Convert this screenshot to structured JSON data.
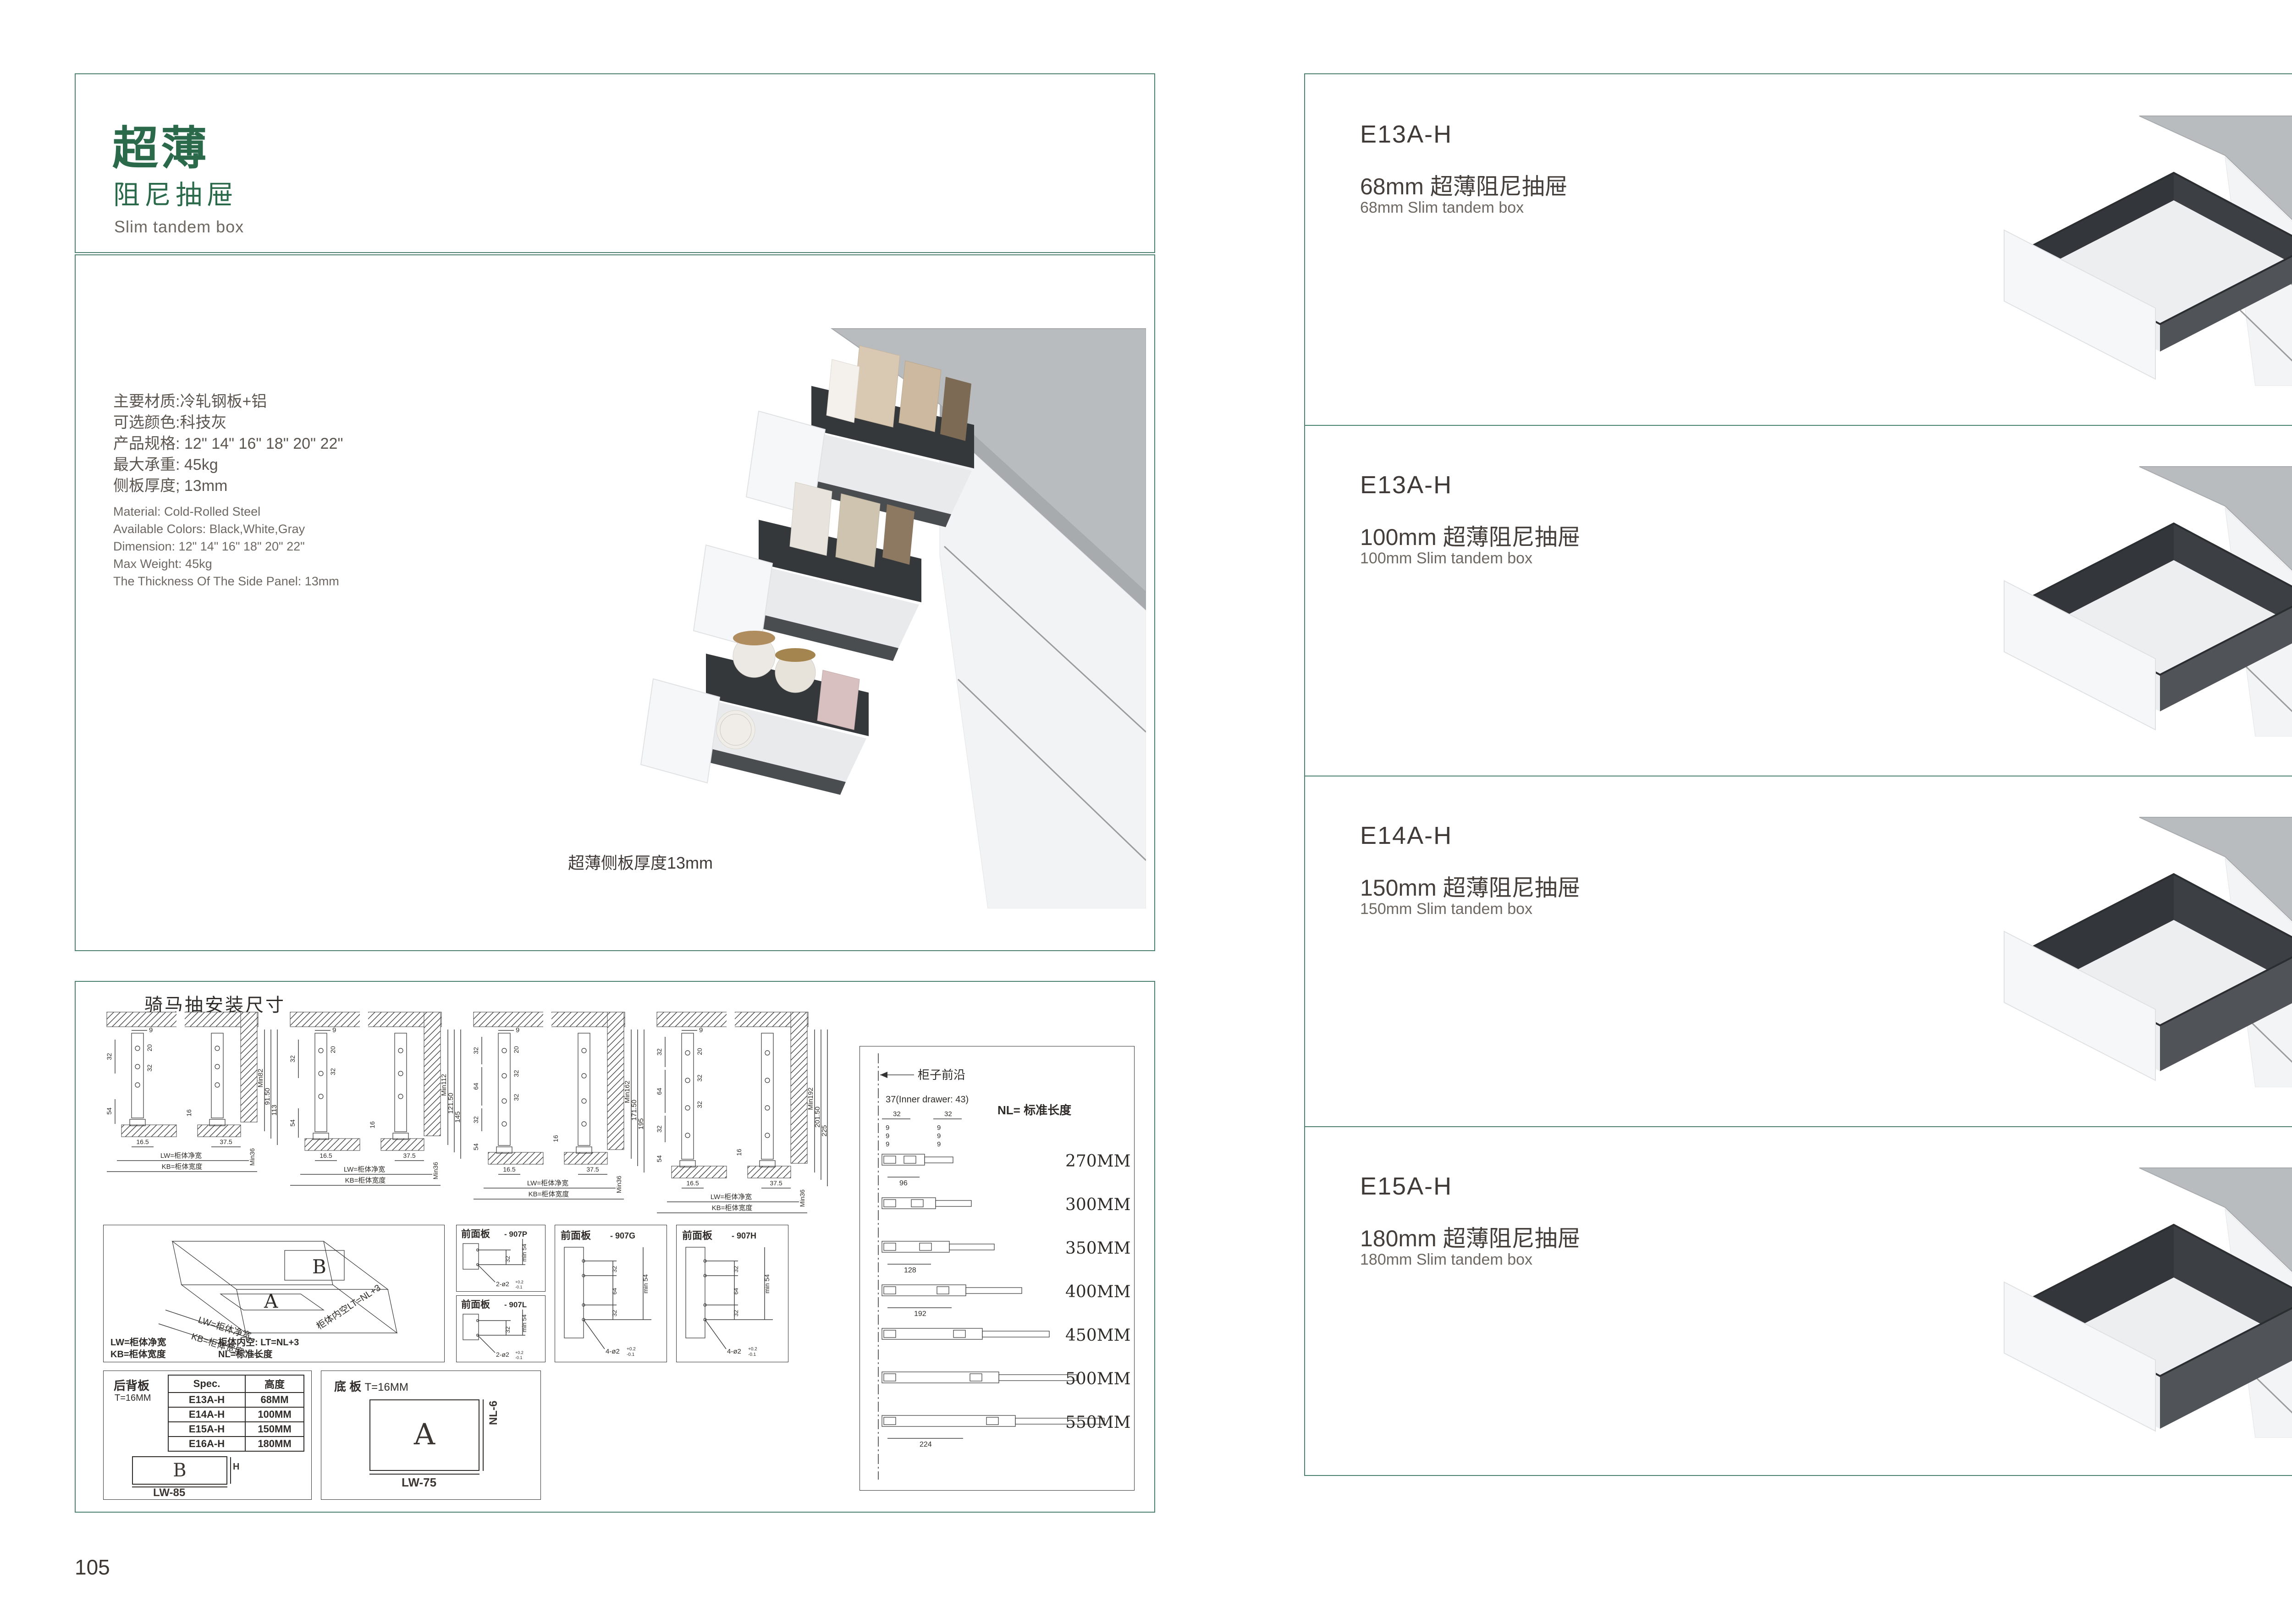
{
  "colors": {
    "accent_green": "#2a6a4b",
    "border_teal": "#4b8071",
    "text_dark": "#3b3632",
    "text_gray": "#6e6862",
    "photo_charcoal": "#35383b",
    "photo_counter": "#b9bcbe"
  },
  "page_left": {
    "page_number": "105",
    "header": {
      "title_cn_bold": "超薄",
      "title_cn_sub": "阻尼抽屉",
      "title_en": "Slim tandem box"
    },
    "specs_cn": [
      "主要材质:冷轧钢板+铝",
      "可选颜色:科技灰",
      "产品规格: 12\" 14\" 16\" 18\" 20\" 22\"",
      "最大承重: 45kg",
      "侧板厚度; 13mm"
    ],
    "specs_en": [
      "Material: Cold-Rolled Steel",
      "Available Colors: Black,White,Gray",
      "Dimension: 12\" 14\" 16\" 18\" 20\" 22\"",
      "Max Weight: 45kg",
      "The Thickness Of The Side Panel: 13mm"
    ],
    "photo_caption": "超薄侧板厚度13mm",
    "tech": {
      "title": "骑马抽安装尺寸",
      "cross_sections": [
        {
          "top9": "9",
          "col20": "20",
          "col32a": "32",
          "col32b": "",
          "leftA": "32",
          "leftB": "",
          "leftC": "",
          "left54": "54",
          "mid16": "16",
          "r1": "Min82",
          "r2": "91.50",
          "r3": "113",
          "b1": "16.5",
          "b2": "37.5",
          "b3": "Min36",
          "lw": "LW=柜体净宽",
          "kb": "KB=柜体宽度"
        },
        {
          "top9": "9",
          "col20": "20",
          "col32a": "32",
          "col32b": "",
          "leftA": "32",
          "leftB": "",
          "leftC": "",
          "left54": "54",
          "mid16": "16",
          "r1": "Min112",
          "r2": "121.50",
          "r3": "145",
          "b1": "16.5",
          "b2": "37.5",
          "b3": "Min36",
          "lw": "LW=柜体净宽",
          "kb": "KB=柜体宽度"
        },
        {
          "top9": "9",
          "col20": "20",
          "col32a": "32",
          "col32b": "32",
          "leftA": "32",
          "leftB": "64",
          "leftC": "32",
          "left54": "54",
          "mid16": "16",
          "r1": "Min162",
          "r2": "171.50",
          "r3": "195",
          "b1": "16.5",
          "b2": "37.5",
          "b3": "Min36",
          "lw": "LW=柜体净宽",
          "kb": "KB=柜体宽度"
        },
        {
          "top9": "9",
          "col20": "20",
          "col32a": "32",
          "col32b": "32",
          "leftA": "32",
          "leftB": "64",
          "leftC": "32",
          "left54": "54",
          "mid16": "16",
          "r1": "Min192",
          "r2": "201.50",
          "r3": "225",
          "b1": "16.5",
          "b2": "37.5",
          "b3": "Min36",
          "lw": "LW=柜体净宽",
          "kb": "KB=柜体宽度"
        }
      ],
      "box3d": {
        "letter_a": "A",
        "letter_b": "B",
        "edge_lw": "LW=柜体净宽",
        "edge_kb": "KB=柜体宽度",
        "edge_lt": "柜体内空LT=NL+3",
        "legend_lw": "LW=柜体净宽",
        "legend_lt": "柜体内空: LT=NL+3",
        "legend_kb": "KB=柜体宽度",
        "legend_nl": "NL=标准长度"
      },
      "front_panels": [
        {
          "title": "前面板",
          "code": "- 907P",
          "dim32": "32",
          "min54": "min 54",
          "holes": "2-ø2",
          "tol_up": "+0.2",
          "tol_dn": "-0.1"
        },
        {
          "title": "前面板",
          "code": "- 907L",
          "dim32": "32",
          "min54": "min 54",
          "holes": "2-ø2",
          "tol_up": "+0.2",
          "tol_dn": "-0.1"
        },
        {
          "title": "前面板",
          "code": "- 907G",
          "dim32a": "32",
          "dim64": "64",
          "dim32b": "32",
          "min54": "min 54",
          "holes": "4-ø2",
          "tol_up": "+0.2",
          "tol_dn": "-0.1"
        },
        {
          "title": "前面板",
          "code": "- 907H",
          "dim32a": "32",
          "dim64": "64",
          "dim32b": "32",
          "min54": "min 54",
          "holes": "4-ø2",
          "tol_up": "+0.2",
          "tol_dn": "-0.1"
        }
      ],
      "back_panel": {
        "name": "后背板",
        "thickness": "T=16MM",
        "table": {
          "h1": "Spec.",
          "h2": "高度",
          "rows": [
            [
              "E13A-H",
              "68MM"
            ],
            [
              "E14A-H",
              "100MM"
            ],
            [
              "E15A-H",
              "150MM"
            ],
            [
              "E16A-H",
              "180MM"
            ]
          ]
        },
        "letter": "B",
        "dim_h": "H",
        "dim_w": "LW-85"
      },
      "bottom_panel": {
        "name": "底 板",
        "thickness": "T=16MM",
        "letter": "A",
        "dim_h": "NL-6",
        "dim_w": "LW-75"
      },
      "rails": {
        "front_edge": "柜子前沿",
        "inner_note": "37(Inner drawer: 43)",
        "nl_label": "NL= 标准长度",
        "c1_32": "32",
        "c1_9a": "9",
        "c1_9b": "9",
        "c1_9c": "9",
        "c2_32": "32",
        "c2_9a": "9",
        "c2_9b": "9",
        "c2_9c": "9",
        "lengths": [
          "270MM",
          "300MM",
          "350MM",
          "400MM",
          "450MM",
          "500MM",
          "550MM"
        ],
        "sp96": "96",
        "sp128": "128",
        "sp192": "192",
        "sp224": "224"
      }
    }
  },
  "page_right": {
    "page_number": "106",
    "products": [
      {
        "code": "E13A-H",
        "title_cn": "68mm 超薄阻尼抽屉",
        "title_en": "68mm Slim tandem box"
      },
      {
        "code": "E13A-H",
        "title_cn": "100mm 超薄阻尼抽屉",
        "title_en": "100mm Slim tandem box"
      },
      {
        "code": "E14A-H",
        "title_cn": "150mm 超薄阻尼抽屉",
        "title_en": "150mm Slim tandem box"
      },
      {
        "code": "E15A-H",
        "title_cn": "180mm 超薄阻尼抽屉",
        "title_en": "180mm Slim tandem box"
      }
    ]
  }
}
